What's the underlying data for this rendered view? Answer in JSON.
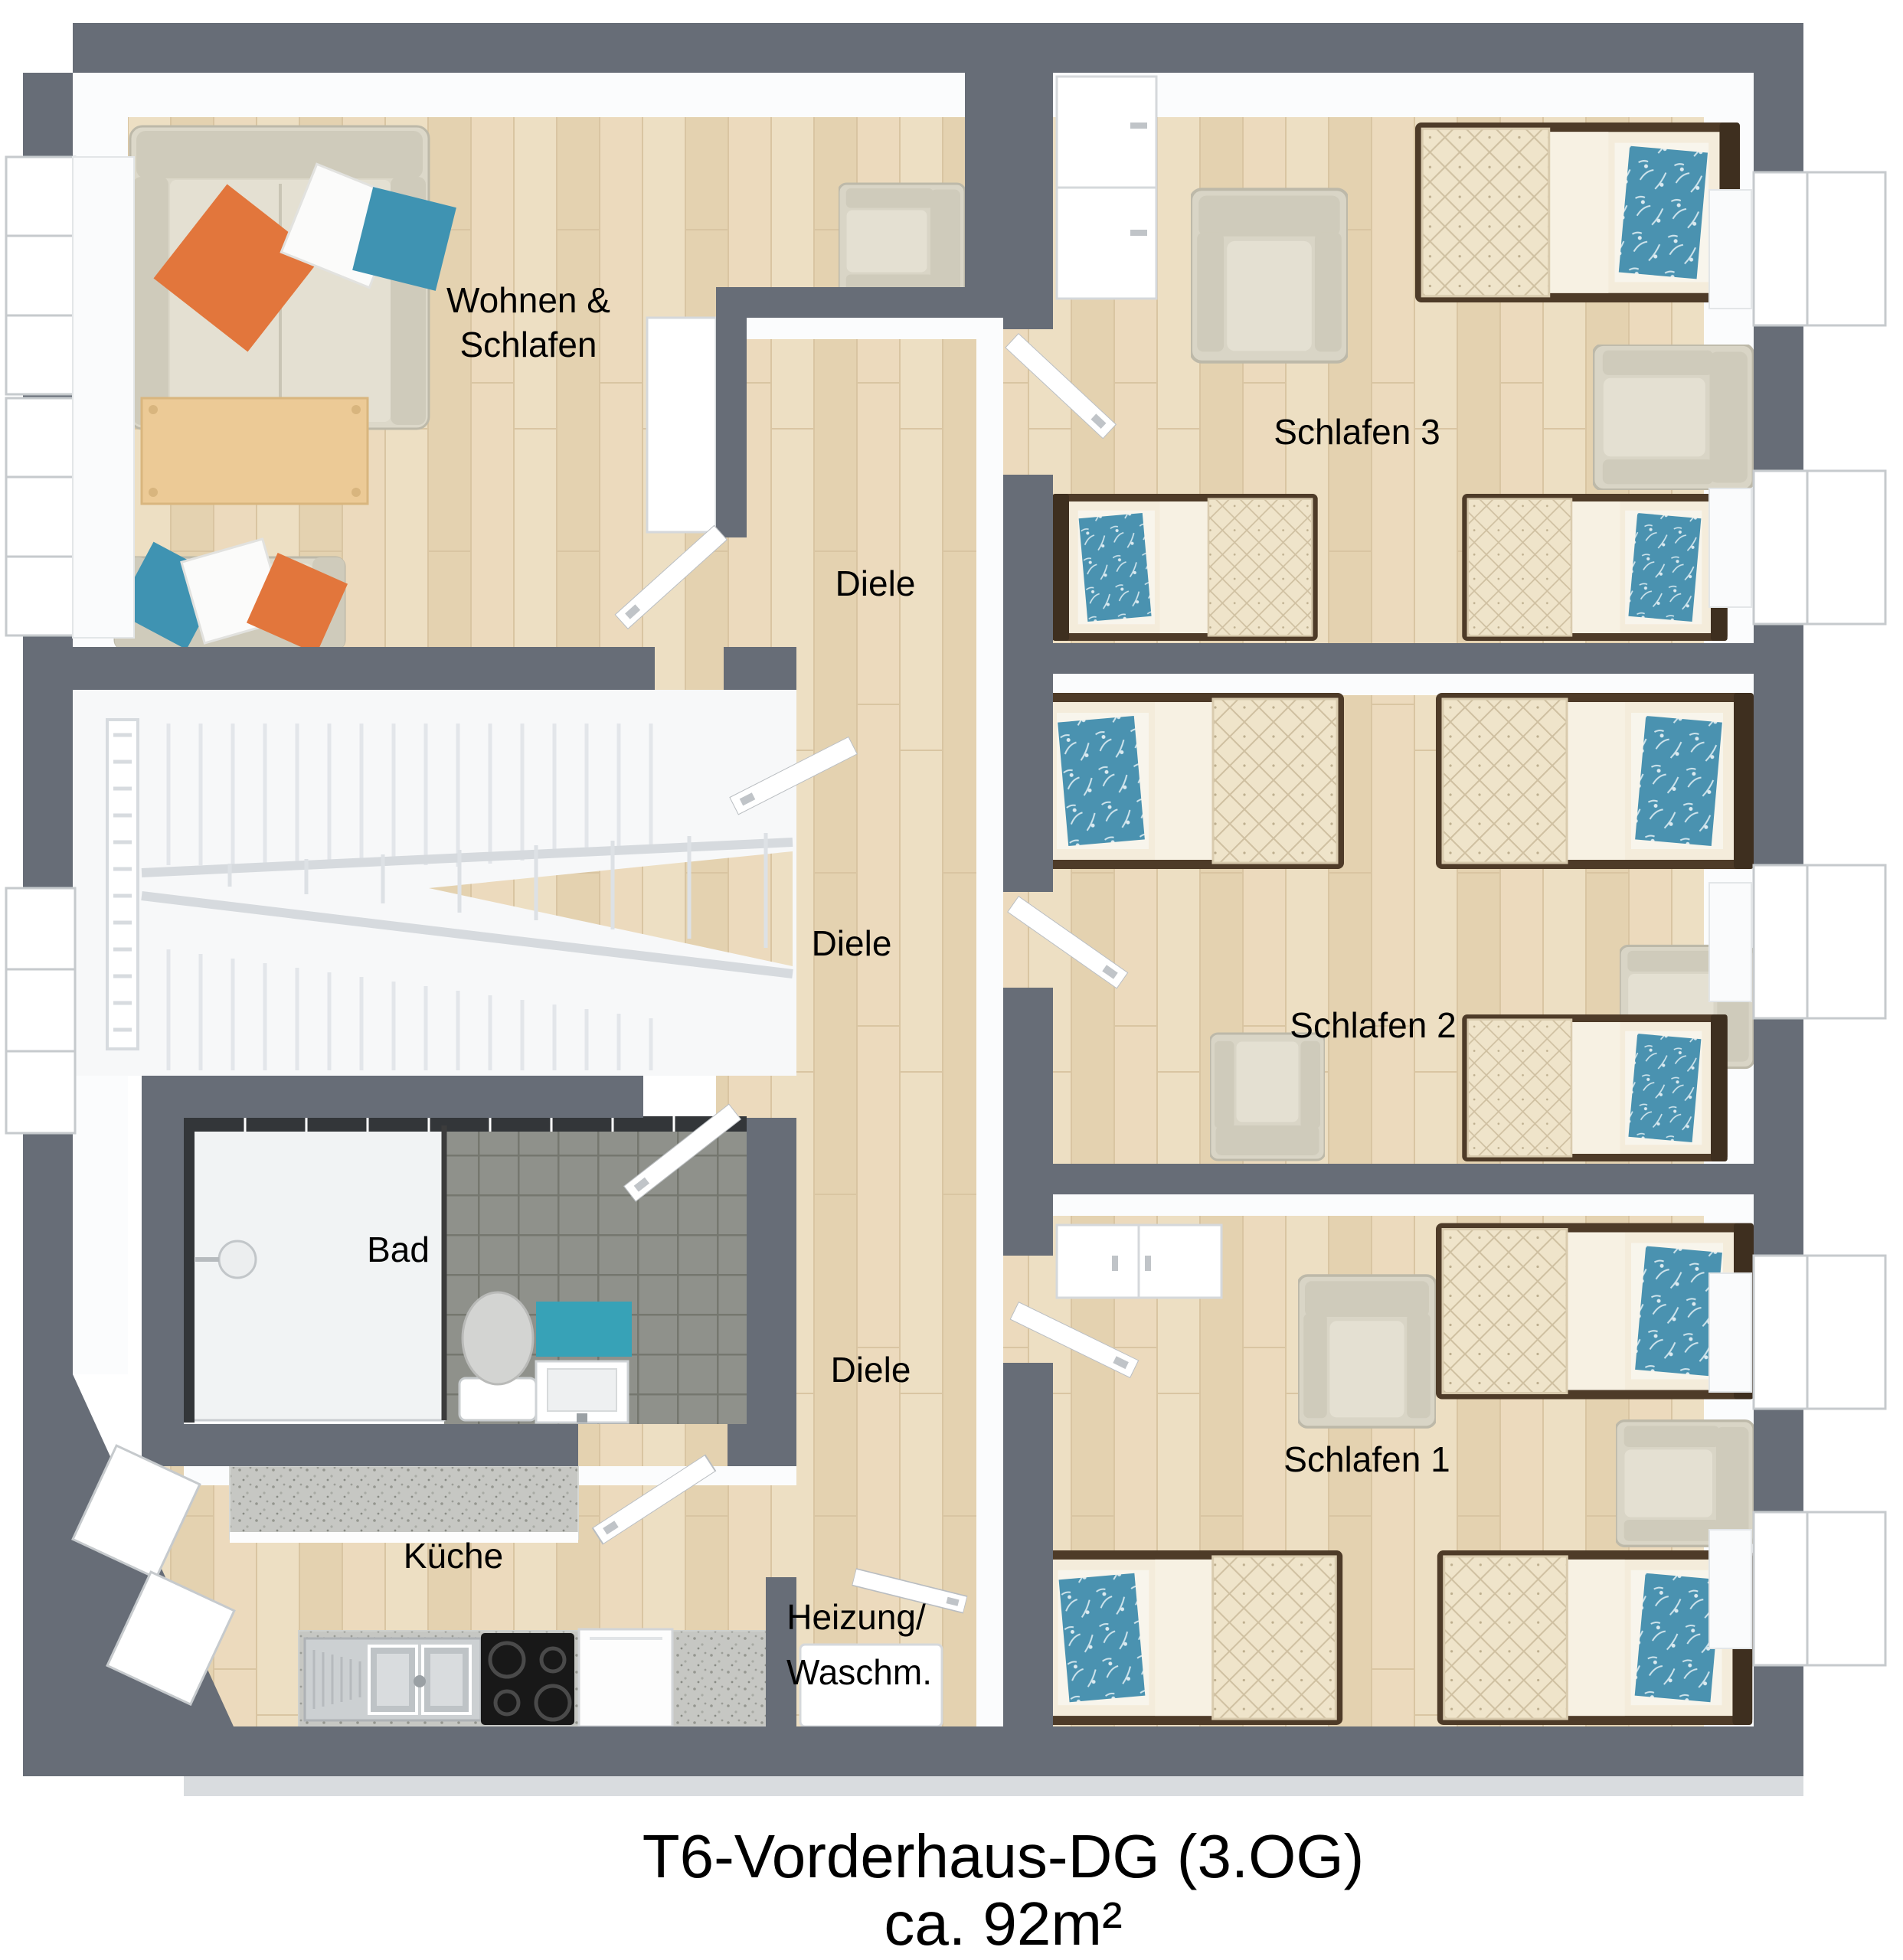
{
  "title": {
    "line1": "T6-Vorderhaus-DG (3.OG)",
    "line2": "ca. 92m²"
  },
  "rooms": {
    "living": {
      "label_line1": "Wohnen &",
      "label_line2": "Schlafen"
    },
    "hall_top": {
      "label": "Diele"
    },
    "hall_mid": {
      "label": "Diele"
    },
    "hall_bottom": {
      "label": "Diele"
    },
    "bath": {
      "label": "Bad"
    },
    "kitchen": {
      "label": "Küche"
    },
    "utility": {
      "label_line1": "Heizung/",
      "label_line2": "Waschm."
    },
    "bedroom3": {
      "label": "Schlafen 3"
    },
    "bedroom2": {
      "label": "Schlafen 2"
    },
    "bedroom1": {
      "label": "Schlafen 1"
    }
  },
  "colors": {
    "wall": "#676d77",
    "wood": "#e9d9bb",
    "stair": "#f7f8f9",
    "tile": "#8f918b",
    "teal": "#3f93b2",
    "orange": "#e2763c",
    "frame": "#4b3a2a",
    "uph": "#dcd8c9",
    "counter": "#c6c7c3",
    "cooktop": "#181818"
  }
}
